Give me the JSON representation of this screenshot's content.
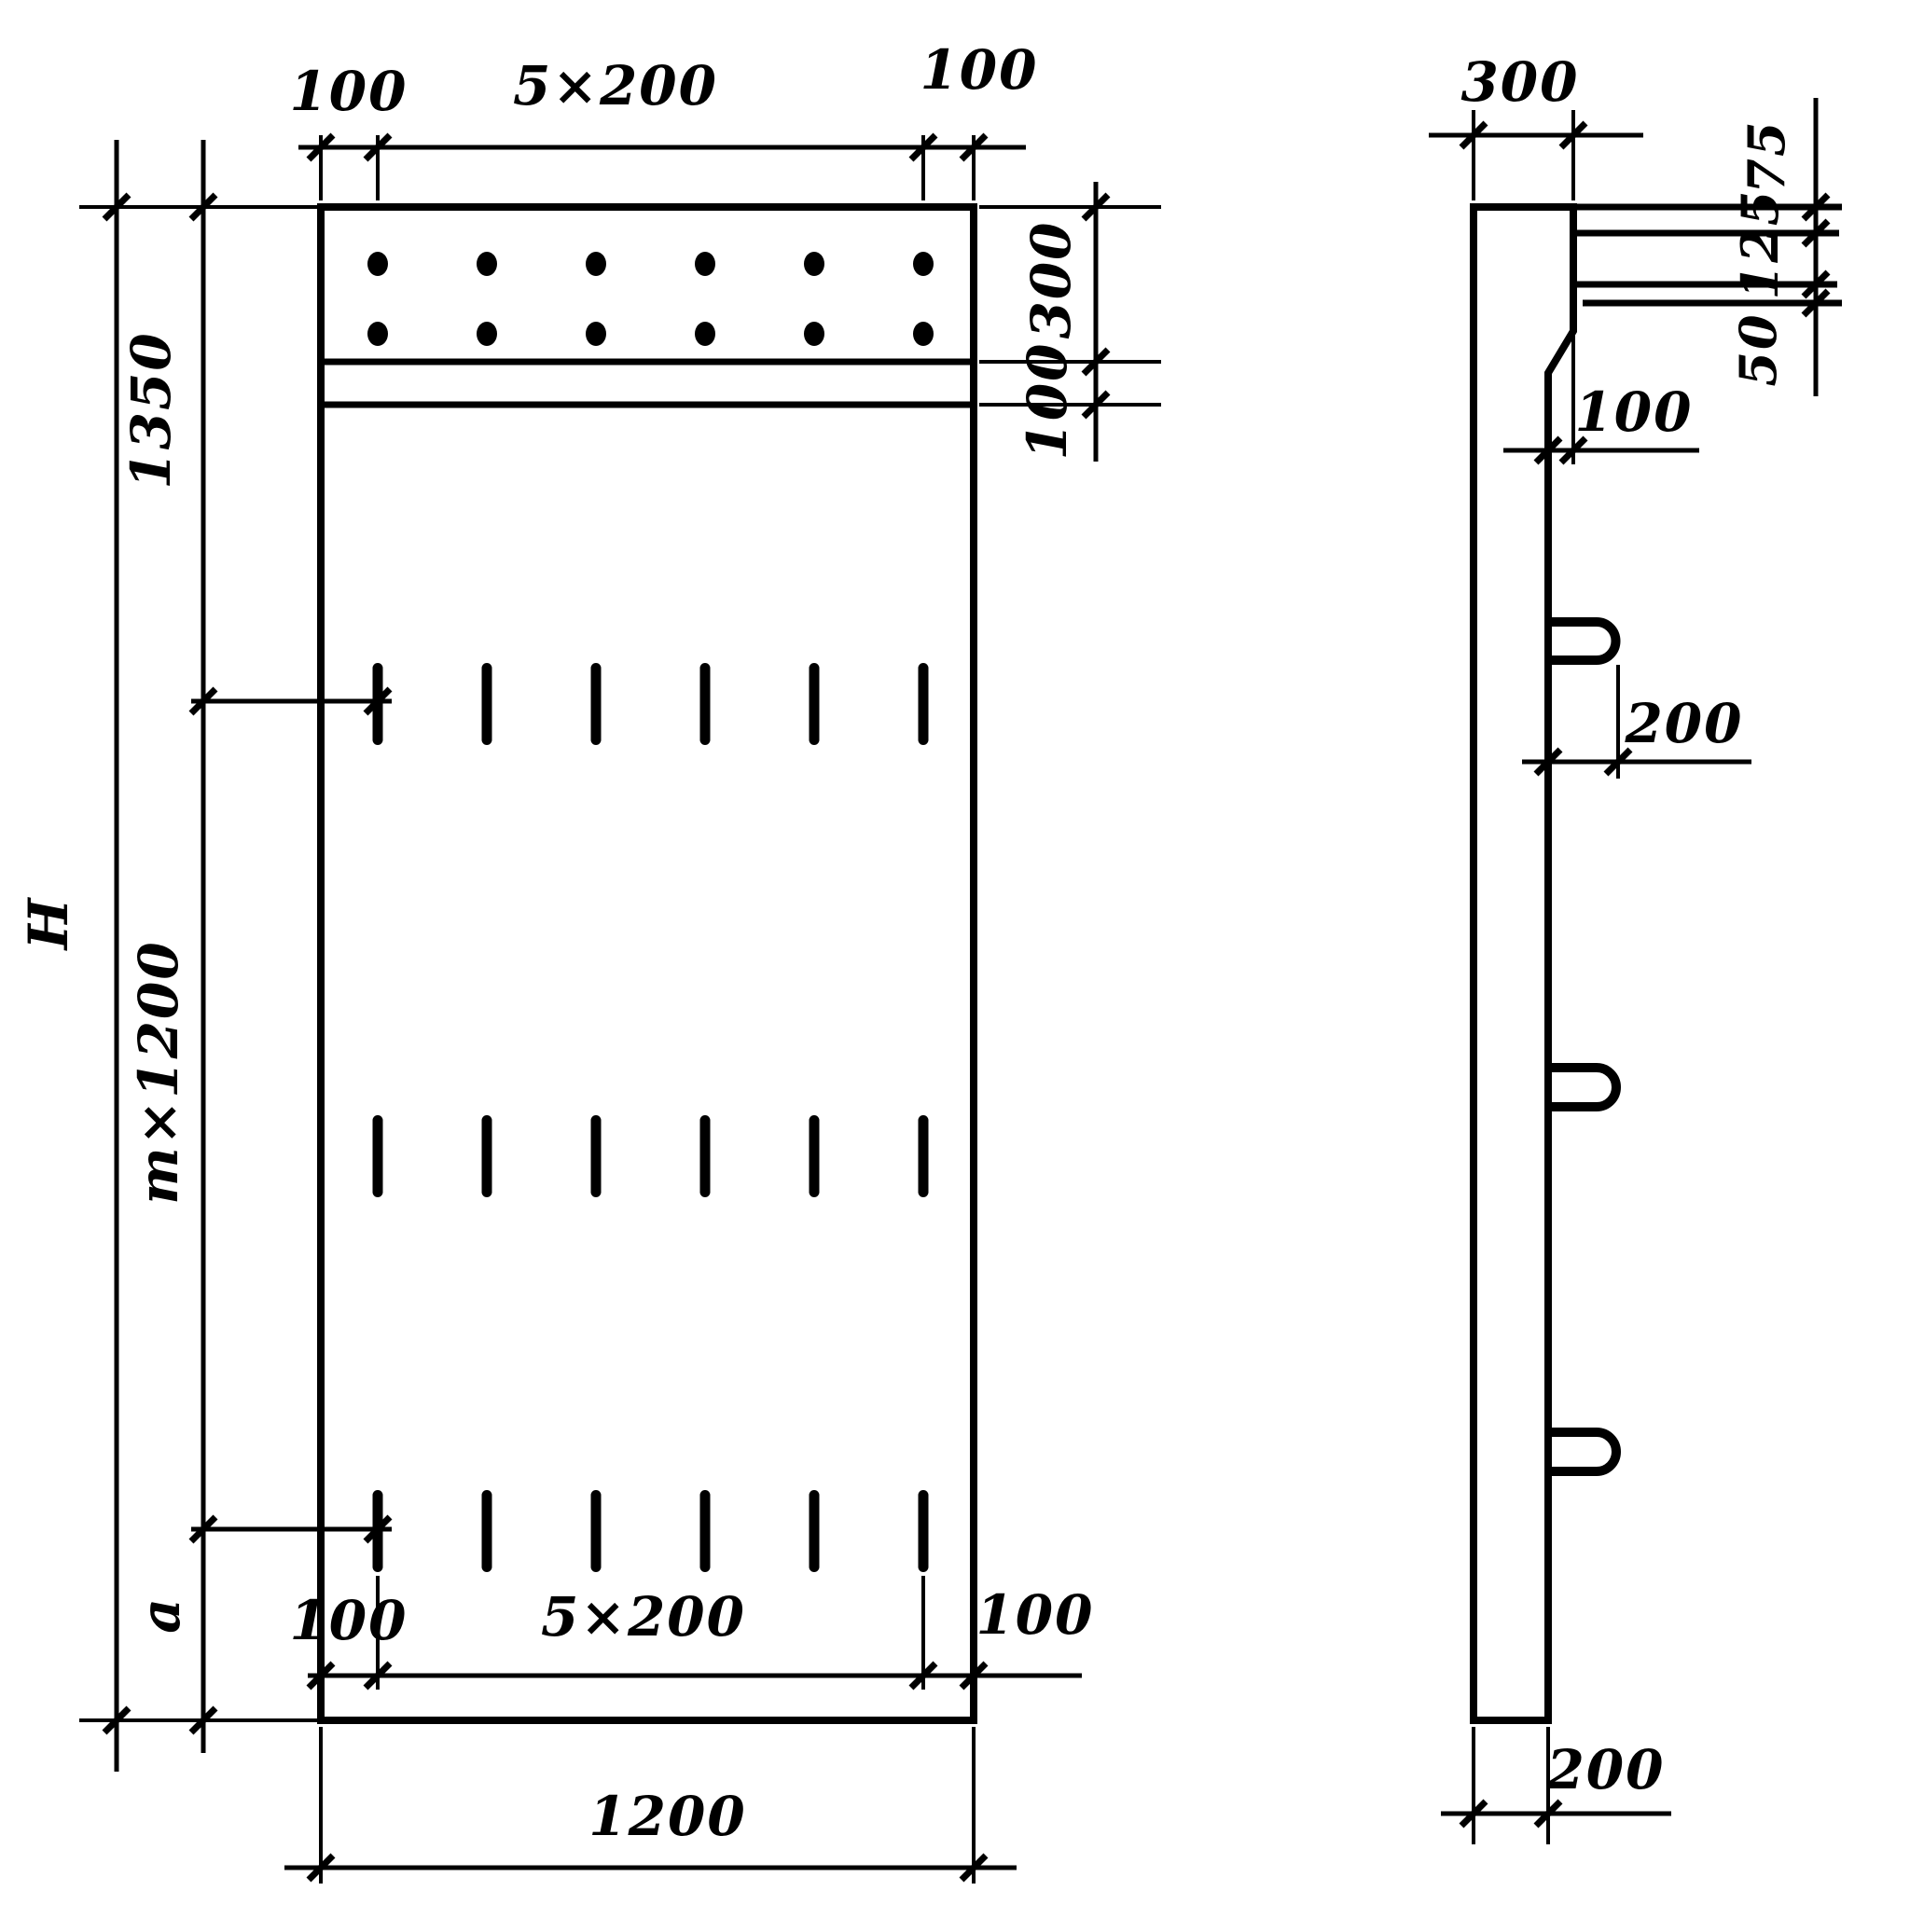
{
  "style": {
    "line_color": "#000000",
    "background": "#ffffff"
  },
  "front_view": {
    "top_dims": {
      "left_margin": "100",
      "hole_spacing": "5×200",
      "right_margin": "100"
    },
    "right_dims": {
      "cap_strip_height": "300",
      "band_height": "100"
    },
    "left_dims": {
      "overall_height": "H",
      "top_zone": "1350",
      "middle_zone": "m×1200",
      "bottom_zone": "a"
    },
    "bottom_dims": {
      "left_margin": "100",
      "loop_spacing": "5×200",
      "right_margin": "100",
      "overall_width": "1200"
    },
    "holes": {
      "rows": 2,
      "columns": 6
    },
    "loop_marks": {
      "rows": 3,
      "columns": 6
    }
  },
  "side_view": {
    "top_width": "300",
    "right_dims": {
      "top": "75",
      "middle": "125",
      "bottom": "50"
    },
    "ledge_offset": "100",
    "loop_reach": "200",
    "bottom_thickness": "200",
    "loops": 3
  }
}
